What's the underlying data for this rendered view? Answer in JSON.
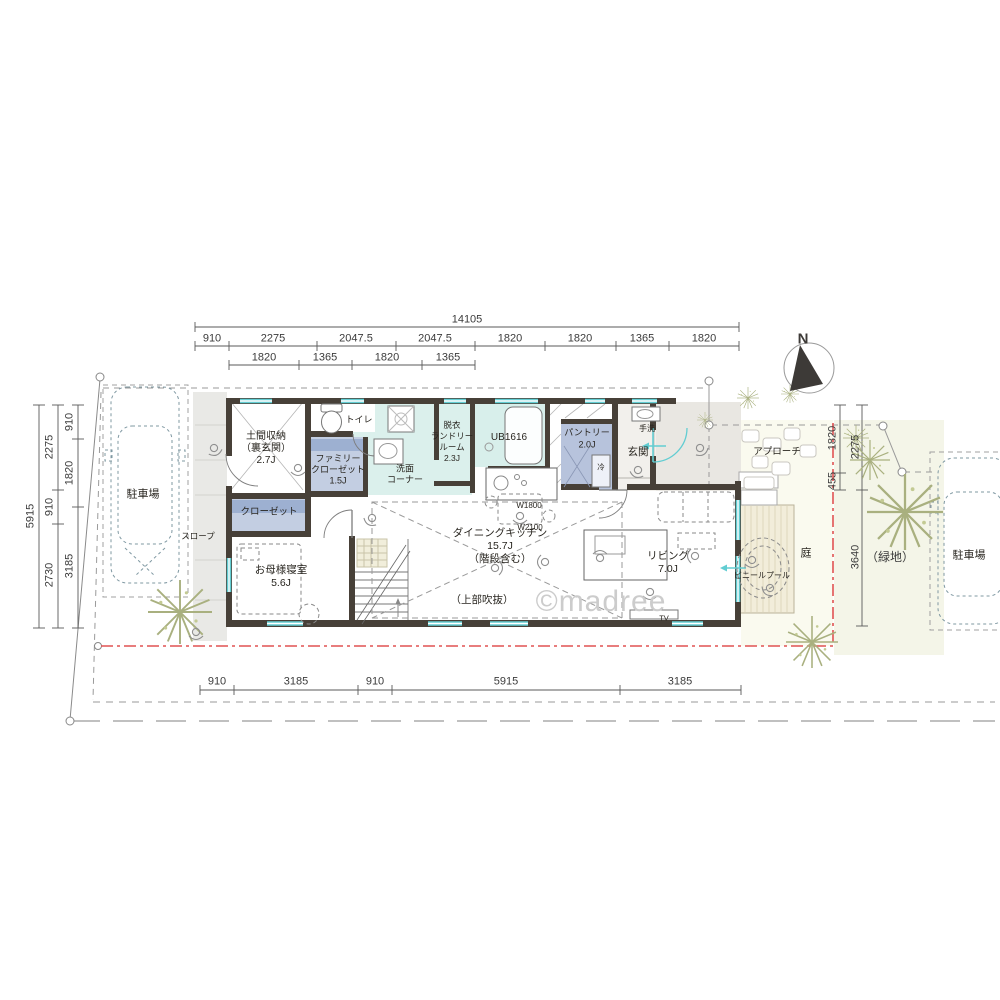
{
  "watermark": "©madree",
  "north_label": "N",
  "dims": {
    "top_total": "14105",
    "top_row1": [
      "910",
      "2275",
      "2047.5",
      "2047.5",
      "1820",
      "1820",
      "1365",
      "1820"
    ],
    "top_row2": [
      "1820",
      "1365",
      "1820",
      "1365"
    ],
    "left_outer": "5915",
    "left_middle": [
      "2275",
      "910",
      "2730"
    ],
    "left_inner": [
      "910",
      "1820",
      "3185"
    ],
    "right_inner": [
      "1820",
      "455"
    ],
    "right_outer": [
      "2275",
      "3640"
    ],
    "green_note": "（緑地）",
    "bottom": [
      "910",
      "3185",
      "910",
      "5915",
      "3185"
    ]
  },
  "rooms": {
    "doma_1": "土間収納",
    "doma_2": "（裏玄関）",
    "doma_3": "2.7J",
    "toilet": "トイレ",
    "famiclo_1": "ファミリー",
    "famiclo_2": "クローゼット",
    "famiclo_3": "1.5J",
    "closet": "クローゼット",
    "senmen_1": "洗面",
    "senmen_2": "コーナー",
    "datsui_1": "脱衣",
    "datsui_2": "ランドリー",
    "datsui_3": "ルーム",
    "datsui_4": "2.3J",
    "bath": "UB1616",
    "pantry_1": "パントリー",
    "pantry_2": "2.0J",
    "tearai": "手洗",
    "genkan": "玄関",
    "bedroom_1": "お母様寝室",
    "bedroom_2": "5.6J",
    "dk_1": "ダイニングキッチン",
    "dk_2": "15.7J",
    "dk_3": "（階段含む）",
    "dk_4": "（上部吹抜）",
    "living_1": "リビング",
    "living_2": "7.0J",
    "fridge": "冷",
    "tv": "TV",
    "counter": "W1800",
    "island": "W2100"
  },
  "site": {
    "parking_left": "駐車場",
    "parking_right": "駐車場",
    "slope": "スロープ",
    "approach": "アプローチ",
    "garden": "庭",
    "pool": "ビニールプール"
  }
}
